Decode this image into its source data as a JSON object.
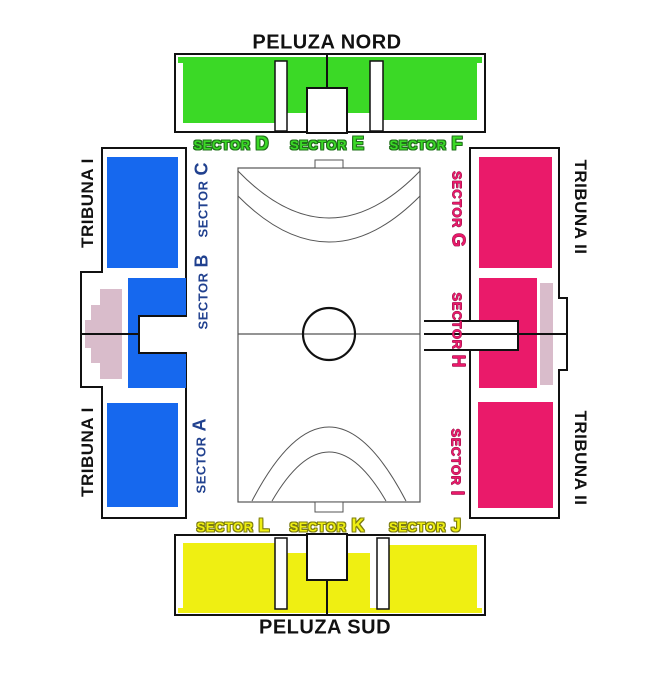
{
  "colors": {
    "green": "#3BD926",
    "green-dark": "#20701B",
    "blue": "#1668EE",
    "navy": "#21418F",
    "pink": "#EA1A6A",
    "pink-dark": "#8E0F45",
    "yellow": "#EFEF12",
    "yellow-dark": "#7D7D10",
    "mauve": "#D9BCCB",
    "outline": "#111111",
    "court-line": "#555555"
  },
  "stands": {
    "north": {
      "title": "PELUZA NORD",
      "sectors": [
        {
          "word": "SECTOR",
          "letter": "D"
        },
        {
          "word": "SECTOR",
          "letter": "E"
        },
        {
          "word": "SECTOR",
          "letter": "F"
        }
      ]
    },
    "south": {
      "title": "PELUZA SUD",
      "sectors": [
        {
          "word": "SECTOR",
          "letter": "L"
        },
        {
          "word": "SECTOR",
          "letter": "K"
        },
        {
          "word": "SECTOR",
          "letter": "J"
        }
      ]
    },
    "west": {
      "title": "TRIBUNA I",
      "sectors": [
        {
          "word": "SECTOR",
          "letter": "C"
        },
        {
          "word": "SECTOR",
          "letter": "B"
        },
        {
          "word": "SECTOR",
          "letter": "A"
        }
      ]
    },
    "east": {
      "title": "TRIBUNA II",
      "sectors": [
        {
          "word": "SECTOR",
          "letter": "G"
        },
        {
          "word": "SECTOR",
          "letter": "H"
        },
        {
          "word": "SECTOR",
          "letter": "I"
        }
      ]
    }
  }
}
